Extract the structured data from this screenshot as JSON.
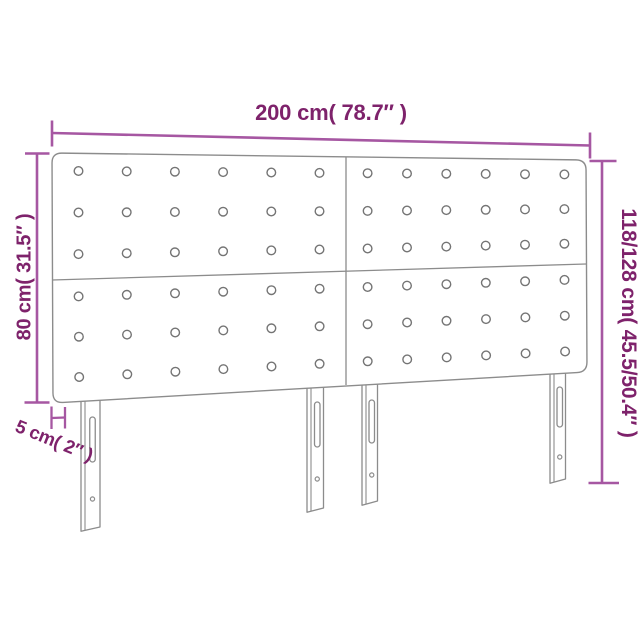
{
  "diagram": {
    "type": "furniture-dimension-diagram",
    "product": "headboard-with-legs",
    "labels": {
      "width": "200 cm( 78.7″ )",
      "height_total": "118/128 cm( 45.5/50.4″ )",
      "height_board": "80 cm( 31.5″ )",
      "thickness": "5 cm( 2″ )"
    },
    "colors": {
      "background": "#ffffff",
      "dimension_line": "#a657a2",
      "dimension_text": "#7e226b",
      "outline": "#8c8c8c",
      "button_stroke": "#747474",
      "panel_fill": "#ffffff"
    },
    "structure": {
      "panels": 4,
      "button_rows_per_panel": 3,
      "button_cols_per_panel": 6,
      "legs": 4
    }
  }
}
